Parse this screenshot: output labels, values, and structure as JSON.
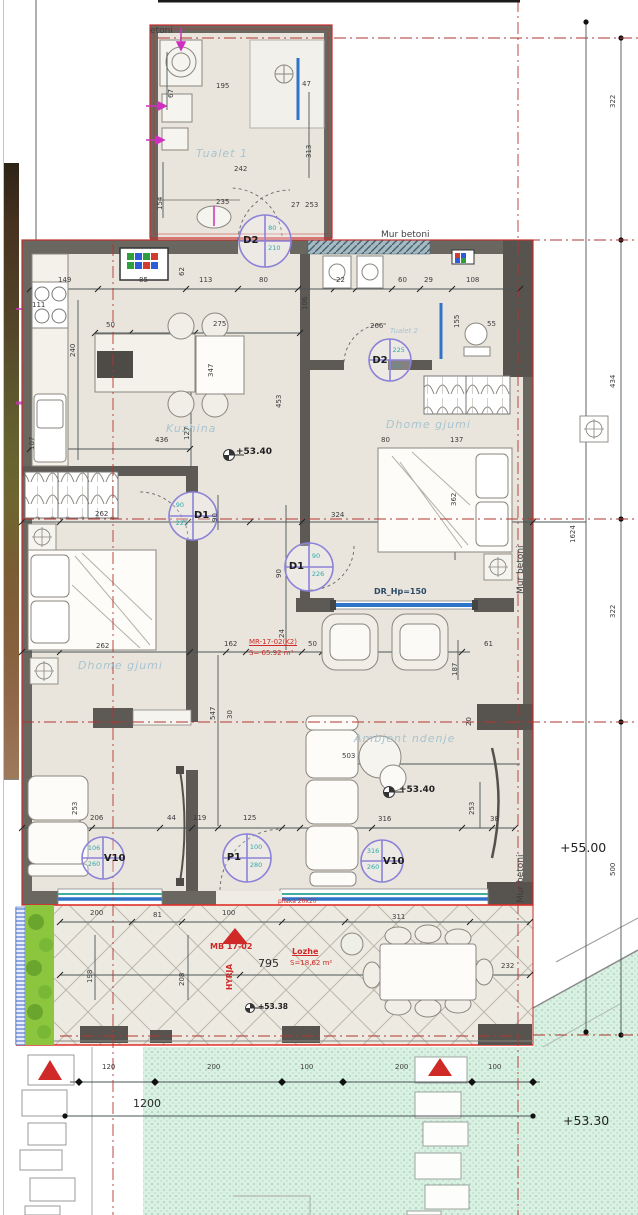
{
  "palette": {
    "boundary_red": "#cc2b2b",
    "axis_red": "#b23530",
    "wall": "#6a6660",
    "wall_dark": "#57534e",
    "floor": "#e9e5dd",
    "window_blue": "#2e74c8",
    "window_teal": "#3fae9e",
    "tag_purple": "#8b82d8",
    "tag_teal": "#2fa8a8",
    "grass_green": "#d9f0e3",
    "hedge_green": "#8cc63f",
    "plumbing_magenta": "#cf30c0"
  },
  "door_tags": [
    {
      "label": "D2",
      "side": "l",
      "v1": "80",
      "v2": "210",
      "cx": 265,
      "cy": 241,
      "r": 26
    },
    {
      "label": "D2",
      "side": "l",
      "v1": "225",
      "v2": "80",
      "cx": 390,
      "cy": 360,
      "r": 21
    },
    {
      "label": "D1",
      "side": "r",
      "v1": "90",
      "v2": "225",
      "cx": 193,
      "cy": 516,
      "r": 24
    },
    {
      "label": "D1",
      "side": "l",
      "v1": "90",
      "v2": "226",
      "cx": 309,
      "cy": 567,
      "r": 24
    },
    {
      "label": "P1",
      "side": "l",
      "v1": "100",
      "v2": "280",
      "cx": 247,
      "cy": 858,
      "r": 24
    },
    {
      "label": "V10",
      "side": "r",
      "v1": "106",
      "v2": "260",
      "cx": 103,
      "cy": 858,
      "r": 21
    },
    {
      "label": "V10",
      "side": "r",
      "v1": "316",
      "v2": "260",
      "cx": 382,
      "cy": 861,
      "r": 21
    }
  ],
  "labels": [
    {
      "t": "etoni",
      "x": 150,
      "y": 27,
      "c": "mur"
    },
    {
      "t": "Mur betoni",
      "x": 381,
      "y": 231,
      "c": "mur"
    },
    {
      "t": "Mur betoni",
      "x": 517,
      "y": 594,
      "c": "murv"
    },
    {
      "t": "Mur betoni",
      "x": 517,
      "y": 903,
      "c": "murv"
    },
    {
      "t": "Tualet 1",
      "x": 196,
      "y": 148,
      "c": "room"
    },
    {
      "t": "Tualet 2",
      "x": 390,
      "y": 328,
      "c": "room-sm"
    },
    {
      "t": "Kuzhina",
      "x": 166,
      "y": 423,
      "c": "room"
    },
    {
      "t": "Dhome gjumi",
      "x": 78,
      "y": 660,
      "c": "room"
    },
    {
      "t": "Dhome gjumi",
      "x": 386,
      "y": 419,
      "c": "room"
    },
    {
      "t": "Ambjent ndenje",
      "x": 354,
      "y": 733,
      "c": "room"
    },
    {
      "t": "+53.40",
      "x": 236,
      "y": 448,
      "c": "lvl"
    },
    {
      "t": "+53.40",
      "x": 399,
      "y": 786,
      "c": "lvl"
    },
    {
      "t": "+53.38",
      "x": 258,
      "y": 1003,
      "c": "lvl-sm"
    },
    {
      "t": "+55.00",
      "x": 560,
      "y": 842,
      "c": "lvl-big"
    },
    {
      "t": "+53.30",
      "x": 563,
      "y": 1115,
      "c": "lvl-big"
    },
    {
      "t": "MR-17-02(K2)",
      "x": 249,
      "y": 639,
      "c": "red redu"
    },
    {
      "t": "S= 65.92 m²",
      "x": 249,
      "y": 650,
      "c": "red"
    },
    {
      "t": "MB 17-02",
      "x": 210,
      "y": 943,
      "c": "redb"
    },
    {
      "t": "HYRJA",
      "x": 226,
      "y": 990,
      "c": "redv"
    },
    {
      "t": "Lozhe",
      "x": 292,
      "y": 948,
      "c": "redb redu"
    },
    {
      "t": "S=18.62 m²",
      "x": 290,
      "y": 960,
      "c": "red"
    },
    {
      "t": "pllaka 20x20",
      "x": 278,
      "y": 899,
      "c": "red red-xs"
    },
    {
      "t": "DR_Hp=150",
      "x": 374,
      "y": 588,
      "c": "drw"
    },
    {
      "t": "67",
      "x": 168,
      "y": 98,
      "c": "dv"
    },
    {
      "t": "195",
      "x": 216,
      "y": 83,
      "c": "d"
    },
    {
      "t": "47",
      "x": 302,
      "y": 81,
      "c": "d"
    },
    {
      "t": "313",
      "x": 306,
      "y": 158,
      "c": "dv"
    },
    {
      "t": "242",
      "x": 234,
      "y": 166,
      "c": "d"
    },
    {
      "t": "154",
      "x": 157,
      "y": 210,
      "c": "dv"
    },
    {
      "t": "235",
      "x": 216,
      "y": 199,
      "c": "d"
    },
    {
      "t": "27",
      "x": 291,
      "y": 202,
      "c": "d"
    },
    {
      "t": "253",
      "x": 305,
      "y": 202,
      "c": "d"
    },
    {
      "t": "149",
      "x": 58,
      "y": 277,
      "c": "d"
    },
    {
      "t": "85",
      "x": 139,
      "y": 277,
      "c": "d"
    },
    {
      "t": "113",
      "x": 199,
      "y": 277,
      "c": "d"
    },
    {
      "t": "80",
      "x": 259,
      "y": 277,
      "c": "d"
    },
    {
      "t": "22",
      "x": 336,
      "y": 277,
      "c": "d"
    },
    {
      "t": "60",
      "x": 398,
      "y": 277,
      "c": "d"
    },
    {
      "t": "29",
      "x": 424,
      "y": 277,
      "c": "d"
    },
    {
      "t": "108",
      "x": 466,
      "y": 277,
      "c": "d"
    },
    {
      "t": "111",
      "x": 32,
      "y": 302,
      "c": "d"
    },
    {
      "t": "240",
      "x": 70,
      "y": 357,
      "c": "dv"
    },
    {
      "t": "50",
      "x": 106,
      "y": 322,
      "c": "d"
    },
    {
      "t": "275",
      "x": 213,
      "y": 321,
      "c": "d"
    },
    {
      "t": "347",
      "x": 208,
      "y": 377,
      "c": "dv"
    },
    {
      "t": "62",
      "x": 179,
      "y": 276,
      "c": "dv"
    },
    {
      "t": "127",
      "x": 184,
      "y": 440,
      "c": "dv"
    },
    {
      "t": "107",
      "x": 29,
      "y": 450,
      "c": "dv"
    },
    {
      "t": "436",
      "x": 155,
      "y": 437,
      "c": "d"
    },
    {
      "t": "453",
      "x": 276,
      "y": 408,
      "c": "dv"
    },
    {
      "t": "106",
      "x": 302,
      "y": 310,
      "c": "dv"
    },
    {
      "t": "155",
      "x": 454,
      "y": 328,
      "c": "dv"
    },
    {
      "t": "266",
      "x": 370,
      "y": 323,
      "c": "d"
    },
    {
      "t": "55",
      "x": 487,
      "y": 321,
      "c": "d"
    },
    {
      "t": "80",
      "x": 381,
      "y": 437,
      "c": "d"
    },
    {
      "t": "137",
      "x": 450,
      "y": 437,
      "c": "d"
    },
    {
      "t": "324",
      "x": 331,
      "y": 512,
      "c": "d"
    },
    {
      "t": "362",
      "x": 451,
      "y": 506,
      "c": "dv"
    },
    {
      "t": "61",
      "x": 484,
      "y": 641,
      "c": "d"
    },
    {
      "t": "187",
      "x": 452,
      "y": 676,
      "c": "dv"
    },
    {
      "t": "90",
      "x": 276,
      "y": 578,
      "c": "dv"
    },
    {
      "t": "90",
      "x": 212,
      "y": 522,
      "c": "dv"
    },
    {
      "t": "262",
      "x": 95,
      "y": 511,
      "c": "d"
    },
    {
      "t": "262",
      "x": 96,
      "y": 643,
      "c": "d"
    },
    {
      "t": "162",
      "x": 224,
      "y": 641,
      "c": "d"
    },
    {
      "t": "50",
      "x": 308,
      "y": 641,
      "c": "d"
    },
    {
      "t": "547",
      "x": 210,
      "y": 720,
      "c": "dv"
    },
    {
      "t": "24",
      "x": 279,
      "y": 638,
      "c": "dv"
    },
    {
      "t": "503",
      "x": 342,
      "y": 753,
      "c": "d"
    },
    {
      "t": "316",
      "x": 378,
      "y": 816,
      "c": "d"
    },
    {
      "t": "253",
      "x": 469,
      "y": 815,
      "c": "dv"
    },
    {
      "t": "38",
      "x": 490,
      "y": 816,
      "c": "d"
    },
    {
      "t": "20",
      "x": 466,
      "y": 726,
      "c": "dv"
    },
    {
      "t": "253",
      "x": 72,
      "y": 815,
      "c": "dv"
    },
    {
      "t": "206",
      "x": 90,
      "y": 815,
      "c": "d"
    },
    {
      "t": "44",
      "x": 167,
      "y": 815,
      "c": "d"
    },
    {
      "t": "119",
      "x": 193,
      "y": 815,
      "c": "d"
    },
    {
      "t": "125",
      "x": 243,
      "y": 815,
      "c": "d"
    },
    {
      "t": "30",
      "x": 227,
      "y": 719,
      "c": "dv"
    },
    {
      "t": "200",
      "x": 90,
      "y": 910,
      "c": "d"
    },
    {
      "t": "81",
      "x": 153,
      "y": 912,
      "c": "d"
    },
    {
      "t": "100",
      "x": 222,
      "y": 910,
      "c": "d"
    },
    {
      "t": "311",
      "x": 392,
      "y": 914,
      "c": "d"
    },
    {
      "t": "198",
      "x": 87,
      "y": 983,
      "c": "dv"
    },
    {
      "t": "208",
      "x": 179,
      "y": 986,
      "c": "dv"
    },
    {
      "t": "795",
      "x": 258,
      "y": 958,
      "c": "db"
    },
    {
      "t": "232",
      "x": 501,
      "y": 963,
      "c": "d"
    },
    {
      "t": "120",
      "x": 102,
      "y": 1064,
      "c": "d"
    },
    {
      "t": "200",
      "x": 207,
      "y": 1064,
      "c": "d"
    },
    {
      "t": "100",
      "x": 300,
      "y": 1064,
      "c": "d"
    },
    {
      "t": "200",
      "x": 395,
      "y": 1064,
      "c": "d"
    },
    {
      "t": "100",
      "x": 488,
      "y": 1064,
      "c": "d"
    },
    {
      "t": "1200",
      "x": 133,
      "y": 1098,
      "c": "db"
    },
    {
      "t": "322",
      "x": 610,
      "y": 108,
      "c": "dv"
    },
    {
      "t": "434",
      "x": 610,
      "y": 388,
      "c": "dv"
    },
    {
      "t": "1624",
      "x": 570,
      "y": 543,
      "c": "dv"
    },
    {
      "t": "322",
      "x": 610,
      "y": 618,
      "c": "dv"
    },
    {
      "t": "500",
      "x": 610,
      "y": 876,
      "c": "dv"
    }
  ]
}
